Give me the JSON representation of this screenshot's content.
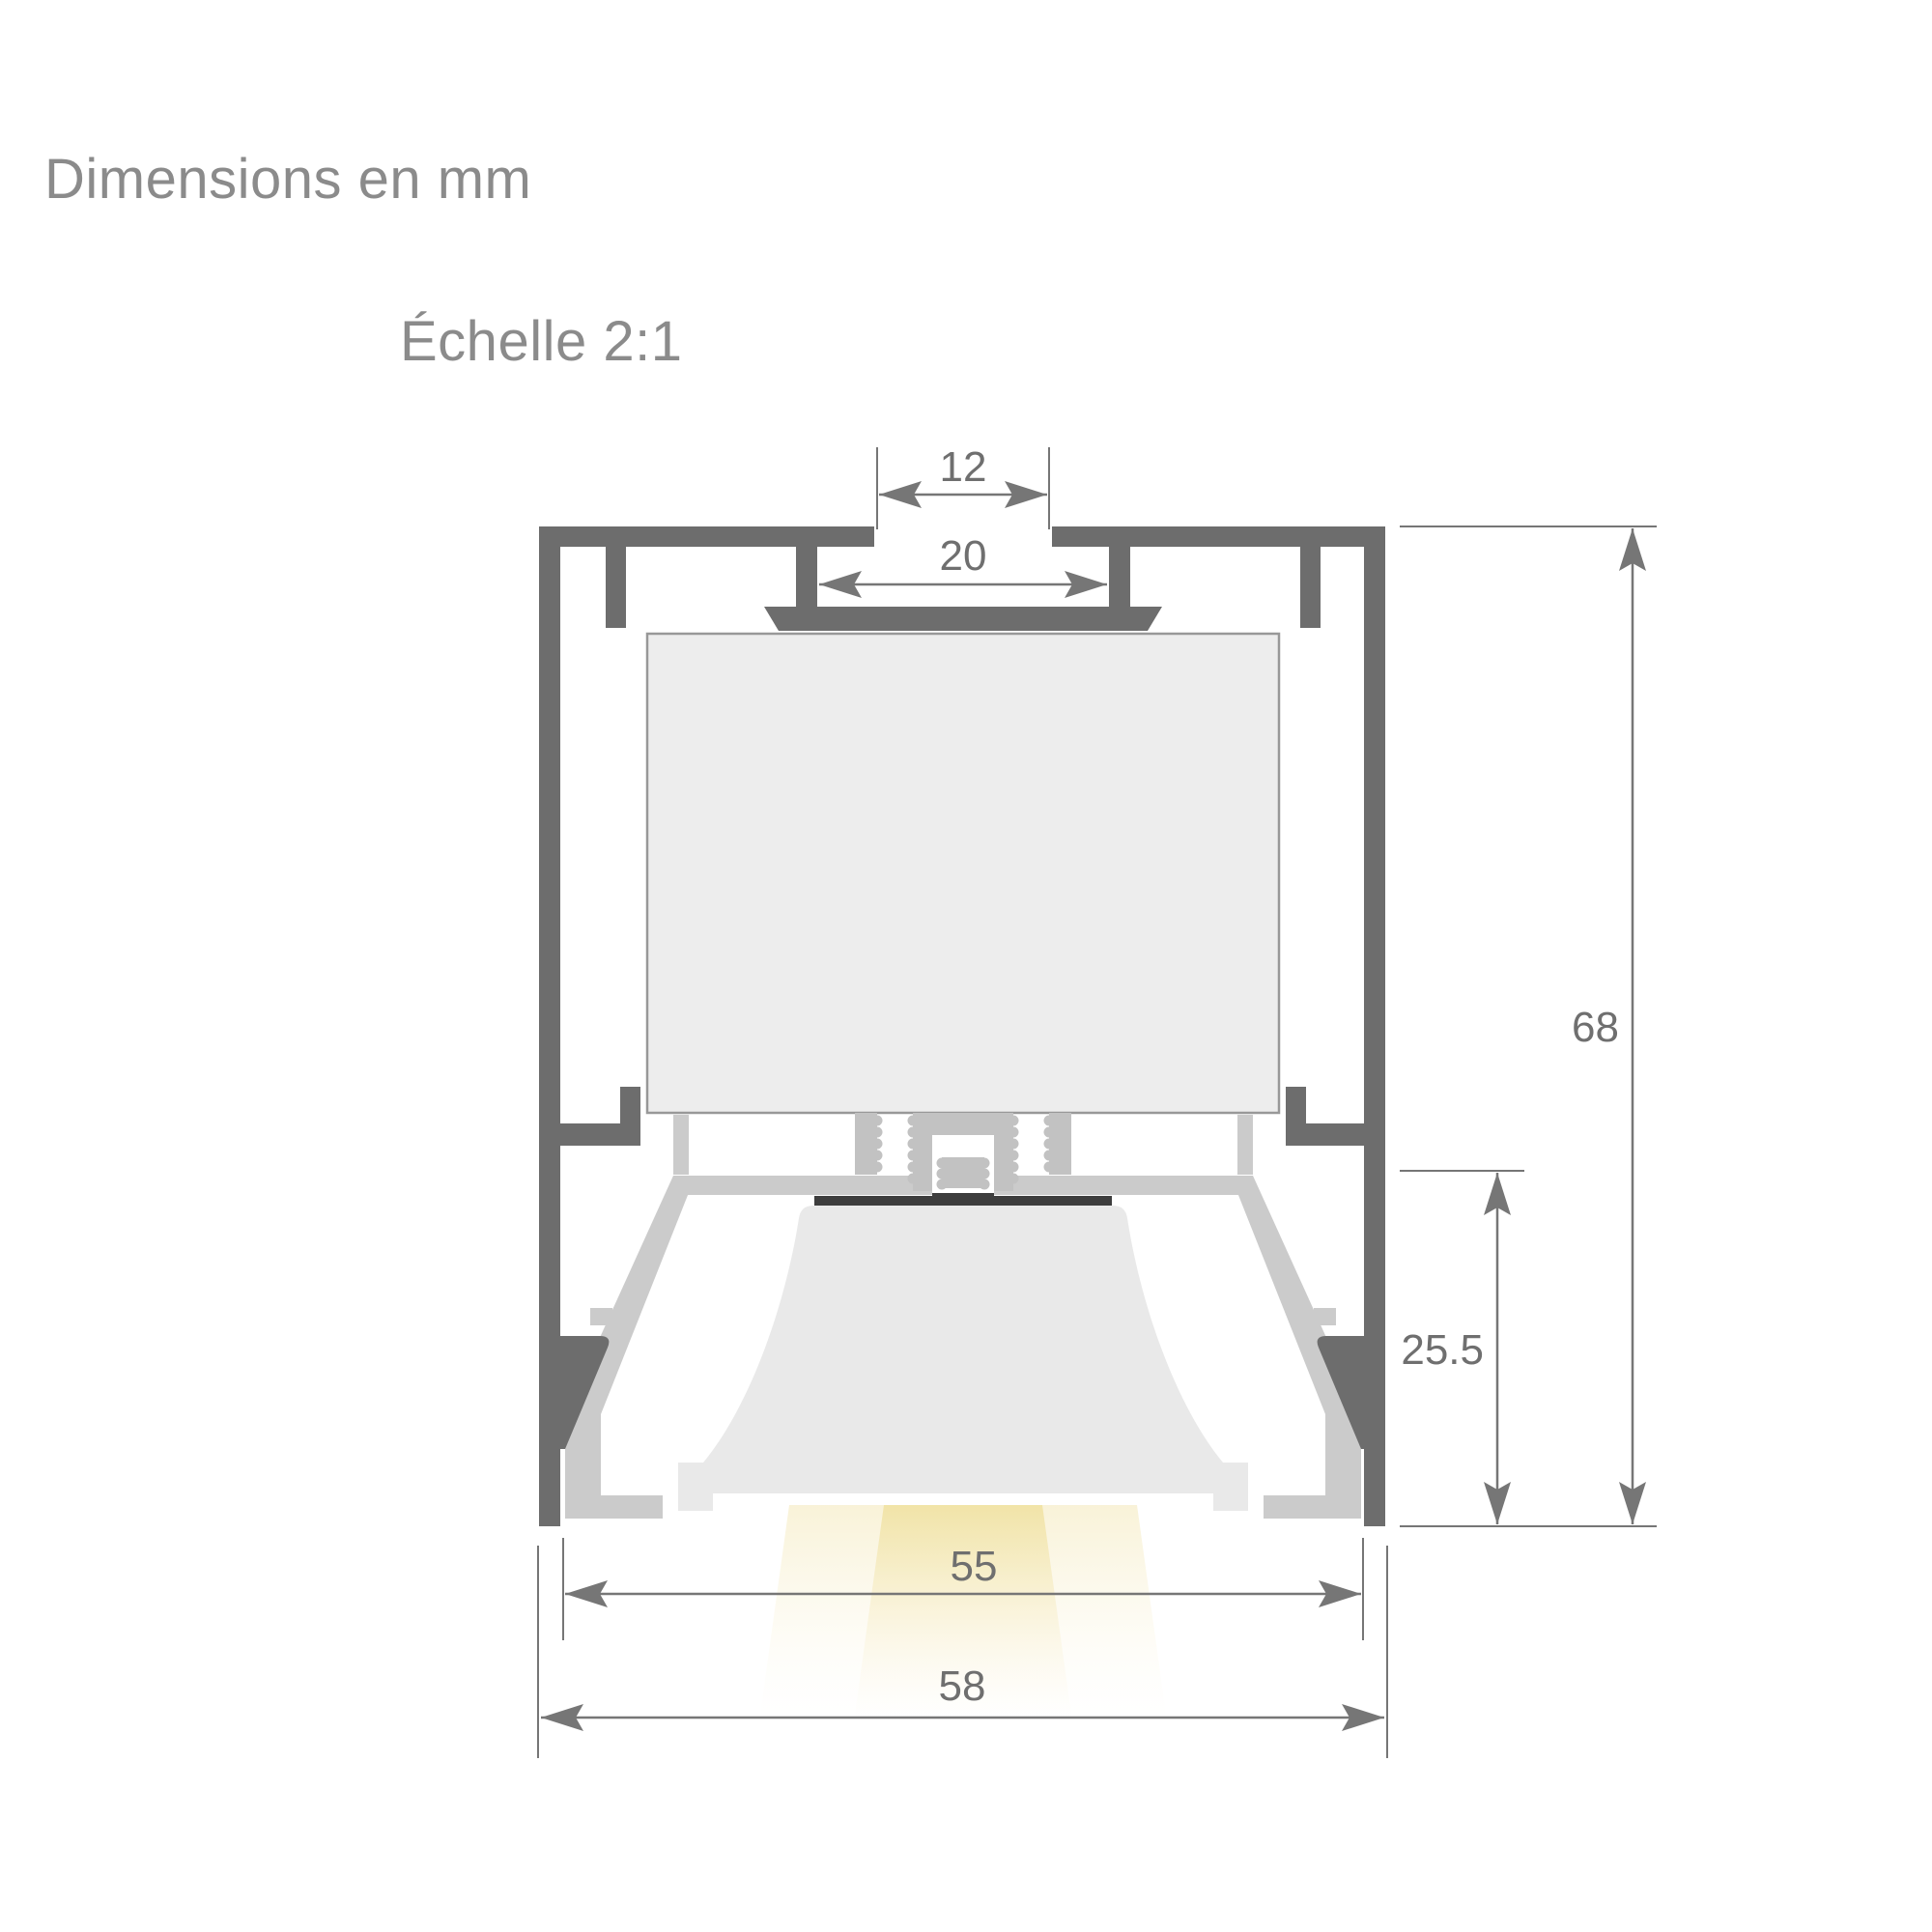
{
  "page": {
    "title": "Dimensions en mm",
    "scale_label": "Échelle 2:1",
    "background": "#ffffff"
  },
  "drawing": {
    "type": "technical-cross-section",
    "subject": "linear-led-profile-cross-section",
    "units": "mm",
    "scale": "2:1",
    "dimensions": {
      "top_slot_opening": "12",
      "inner_slot_width": "20",
      "total_height": "68",
      "optical_chamber_height": "25.5",
      "inner_width": "55",
      "overall_width": "58"
    },
    "colors": {
      "profile_body": "#6d6d6d",
      "mechanism": "#c2c2c2",
      "bracket": "#cbcbcb",
      "driver_box_fill": "#ededed",
      "driver_box_stroke": "#989898",
      "diffuser": "#e9e9e9",
      "led_bar": "#3d3d3d",
      "dimension_lines": "#767676",
      "dimension_text": "#6f6f6f",
      "title_text": "#8b8b8b",
      "beam_center": "#f2e5ad",
      "beam_wing": "#f8f1d3"
    }
  }
}
